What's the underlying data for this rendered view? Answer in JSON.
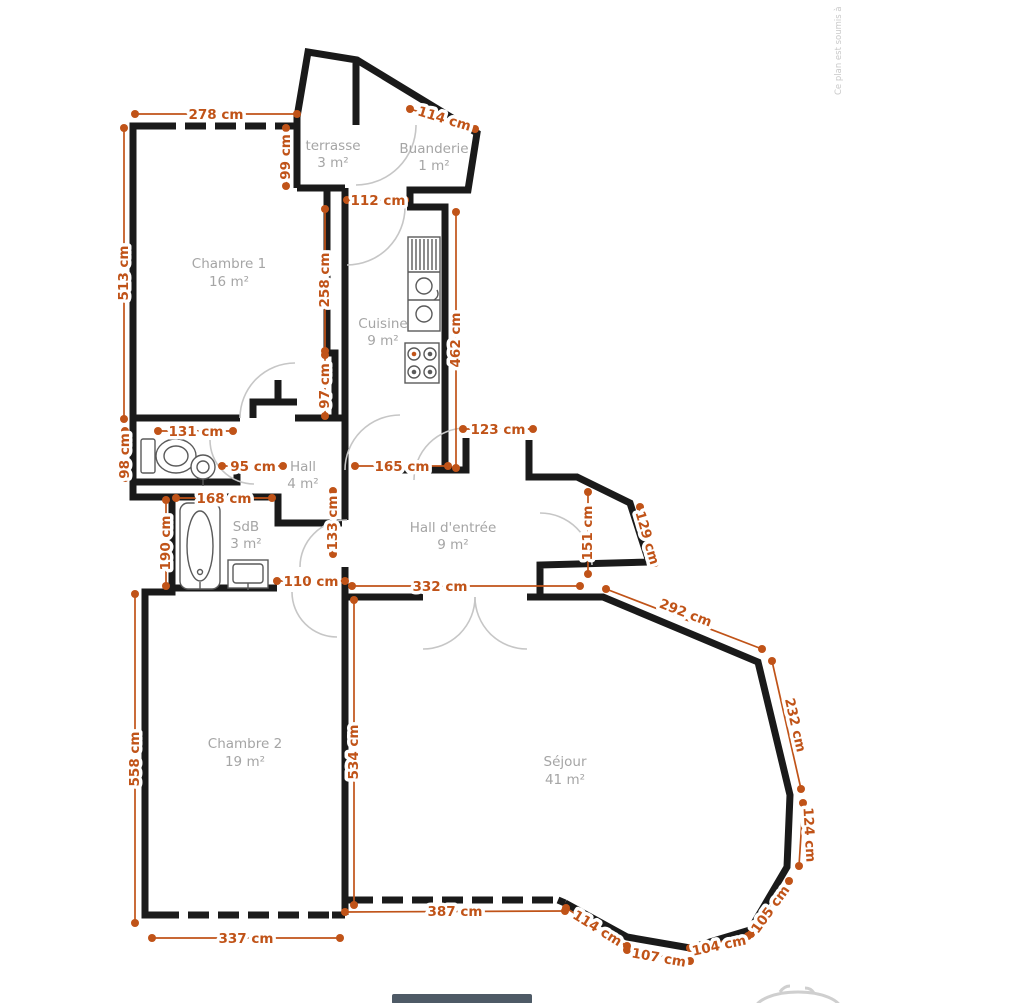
{
  "meta": {
    "watermark": "Ce plan est soumis à",
    "unit": "cm",
    "colors": {
      "dimension": "#c05318",
      "wall": "#1a1a1a",
      "room_label": "#a5a5a5"
    }
  },
  "rooms": [
    {
      "name": "terrasse",
      "area": "3 m²"
    },
    {
      "name": "Buanderie",
      "area": "1 m²"
    },
    {
      "name": "Chambre 1",
      "area": "16 m²"
    },
    {
      "name": "Cuisine",
      "area": "9 m²"
    },
    {
      "name": "Hall",
      "area": "4 m²"
    },
    {
      "name": "SdB",
      "area": "3 m²"
    },
    {
      "name": "Hall d'entrée",
      "area": "9 m²"
    },
    {
      "name": "Chambre 2",
      "area": "19 m²"
    },
    {
      "name": "Séjour",
      "area": "41 m²"
    }
  ],
  "dims": [
    "278 cm",
    "99 cm",
    "114 cm",
    "513 cm",
    "112 cm",
    "258 cm",
    "462 cm",
    "97 cm",
    "131 cm",
    "98 cm",
    "95 cm",
    "165 cm",
    "123 cm",
    "168 cm",
    "190 cm",
    "133 cm",
    "151 cm",
    "129 cm",
    "110 cm",
    "332 cm",
    "292 cm",
    "232 cm",
    "124 cm",
    "105 cm",
    "104 cm",
    "107 cm",
    "114 cm",
    "387 cm",
    "558 cm",
    "534 cm",
    "337 cm"
  ]
}
